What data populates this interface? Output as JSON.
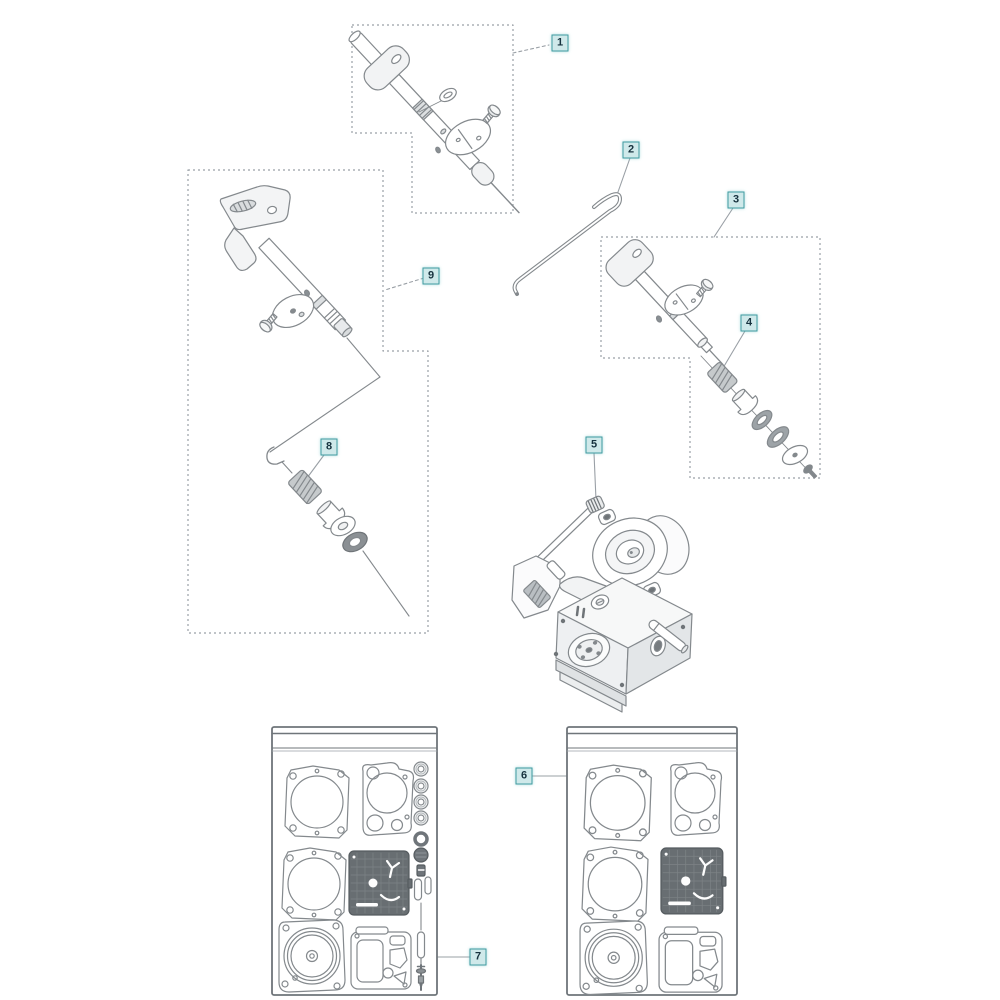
{
  "diagram": {
    "kind": "exploded-parts-diagram",
    "callouts": [
      {
        "label": "1"
      },
      {
        "label": "2"
      },
      {
        "label": "3"
      },
      {
        "label": "4"
      },
      {
        "label": "5"
      },
      {
        "label": "6"
      },
      {
        "label": "7"
      },
      {
        "label": "8"
      },
      {
        "label": "9"
      }
    ],
    "colors": {
      "background": "#ffffff",
      "line_art": "#84898d",
      "dashed_box": "#9aa0a6",
      "callout_background": "#cfe9ea",
      "callout_border": "#3f9aa0",
      "callout_text": "#17323e"
    }
  }
}
